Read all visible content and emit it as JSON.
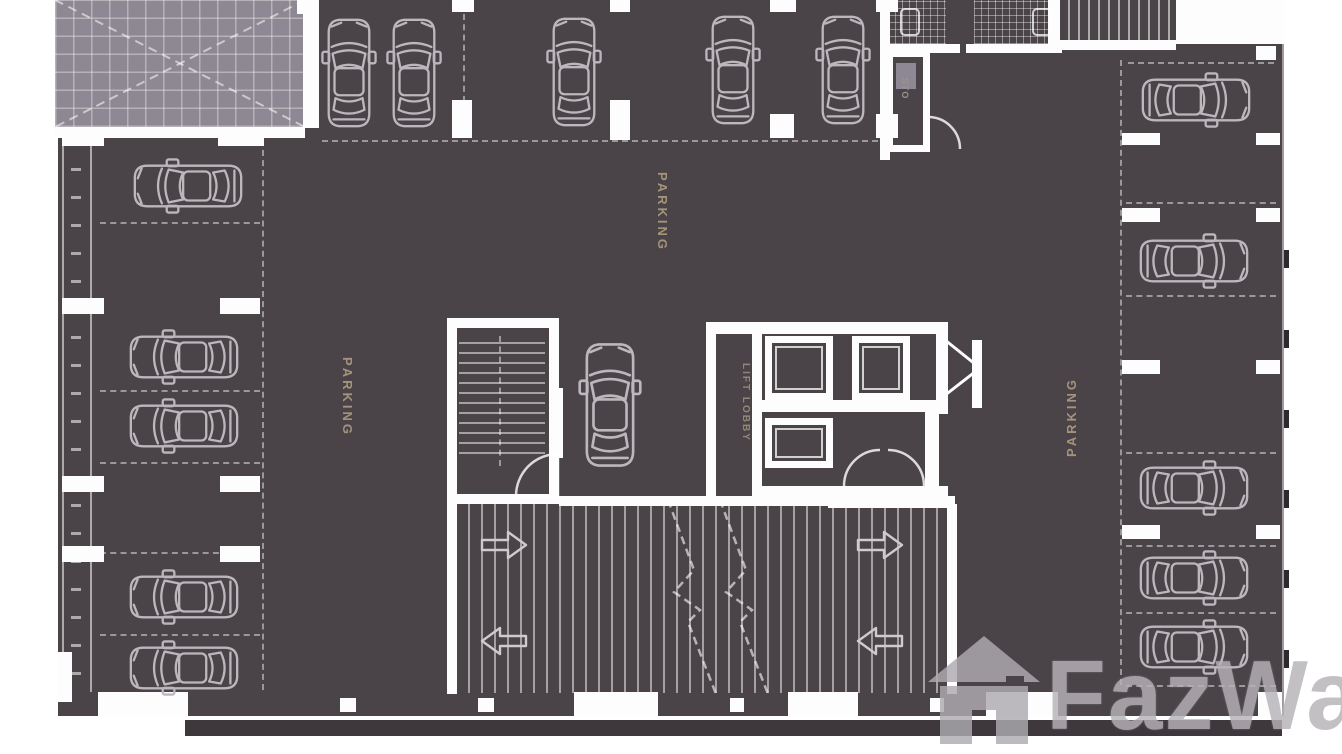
{
  "labels": {
    "parking_center": "PARKING",
    "parking_left": "PARKING",
    "parking_right": "PARKING",
    "lift_lobby": "LIFT LOBBY",
    "storage_room": "STO",
    "watermark": "FazWa"
  },
  "icons": {
    "car": "car-top-view-icon",
    "watermark_house": "house-icon",
    "ramp_arrow": "direction-arrow-icon"
  },
  "colors": {
    "floor": "#4a4347",
    "wall": "#fdfdfd",
    "car_outline": "#bcb6bd",
    "hatch_area": "#8d8893",
    "parking_label": "#a5947c",
    "lift_label": "#938878",
    "watermark_gray": "#b6b3b8"
  },
  "plan": {
    "cars": [
      {
        "cx": 349,
        "cy": 73,
        "rot": 0
      },
      {
        "cx": 414,
        "cy": 73,
        "rot": 0
      },
      {
        "cx": 574,
        "cy": 72,
        "rot": 0
      },
      {
        "cx": 733,
        "cy": 70,
        "rot": 0
      },
      {
        "cx": 843,
        "cy": 70,
        "rot": 0
      },
      {
        "cx": 188,
        "cy": 186,
        "rot": -90
      },
      {
        "cx": 184,
        "cy": 357,
        "rot": -90
      },
      {
        "cx": 184,
        "cy": 426,
        "rot": -90
      },
      {
        "cx": 184,
        "cy": 597,
        "rot": -90
      },
      {
        "cx": 184,
        "cy": 668,
        "rot": -90
      },
      {
        "cx": 610,
        "cy": 405,
        "rot": 0,
        "s": 1.14
      },
      {
        "cx": 1196,
        "cy": 100,
        "rot": 90
      },
      {
        "cx": 1194,
        "cy": 261,
        "rot": 90
      },
      {
        "cx": 1194,
        "cy": 488,
        "rot": 90
      },
      {
        "cx": 1194,
        "cy": 578,
        "rot": 90
      },
      {
        "cx": 1194,
        "cy": 647,
        "rot": 90
      }
    ],
    "columns": [
      {
        "x": 62,
        "y": 128,
        "w": 42,
        "h": 18
      },
      {
        "x": 218,
        "y": 128,
        "w": 46,
        "h": 18
      },
      {
        "x": 62,
        "y": 298,
        "w": 42,
        "h": 16
      },
      {
        "x": 220,
        "y": 298,
        "w": 40,
        "h": 16
      },
      {
        "x": 62,
        "y": 476,
        "w": 42,
        "h": 16
      },
      {
        "x": 220,
        "y": 476,
        "w": 40,
        "h": 16
      },
      {
        "x": 62,
        "y": 546,
        "w": 42,
        "h": 16
      },
      {
        "x": 220,
        "y": 546,
        "w": 40,
        "h": 16
      },
      {
        "x": 297,
        "y": 0,
        "w": 18,
        "h": 14
      },
      {
        "x": 452,
        "y": 0,
        "w": 22,
        "h": 12
      },
      {
        "x": 452,
        "y": 100,
        "w": 20,
        "h": 38
      },
      {
        "x": 610,
        "y": 0,
        "w": 20,
        "h": 12
      },
      {
        "x": 610,
        "y": 100,
        "w": 20,
        "h": 40
      },
      {
        "x": 770,
        "y": 0,
        "w": 26,
        "h": 12
      },
      {
        "x": 770,
        "y": 114,
        "w": 24,
        "h": 24
      },
      {
        "x": 876,
        "y": 0,
        "w": 22,
        "h": 12
      },
      {
        "x": 876,
        "y": 114,
        "w": 22,
        "h": 24
      },
      {
        "x": 1122,
        "y": 133,
        "w": 38,
        "h": 12
      },
      {
        "x": 1256,
        "y": 133,
        "w": 24,
        "h": 12
      },
      {
        "x": 1122,
        "y": 208,
        "w": 38,
        "h": 14
      },
      {
        "x": 1256,
        "y": 208,
        "w": 24,
        "h": 14
      },
      {
        "x": 1122,
        "y": 360,
        "w": 38,
        "h": 14
      },
      {
        "x": 1256,
        "y": 360,
        "w": 24,
        "h": 14
      },
      {
        "x": 1122,
        "y": 525,
        "w": 38,
        "h": 14
      },
      {
        "x": 1256,
        "y": 525,
        "w": 24,
        "h": 14
      },
      {
        "x": 98,
        "y": 692,
        "w": 90,
        "h": 24
      },
      {
        "x": 574,
        "y": 692,
        "w": 84,
        "h": 24
      },
      {
        "x": 788,
        "y": 692,
        "w": 70,
        "h": 24
      },
      {
        "x": 986,
        "y": 692,
        "w": 72,
        "h": 24
      },
      {
        "x": 340,
        "y": 698,
        "w": 16,
        "h": 14
      },
      {
        "x": 478,
        "y": 698,
        "w": 16,
        "h": 14
      },
      {
        "x": 730,
        "y": 698,
        "w": 14,
        "h": 14
      },
      {
        "x": 930,
        "y": 698,
        "w": 14,
        "h": 14
      },
      {
        "x": 1258,
        "y": 692,
        "w": 24,
        "h": 24
      }
    ],
    "dashes": [
      {
        "x": 100,
        "y": 222,
        "len": 160,
        "o": "h"
      },
      {
        "x": 100,
        "y": 390,
        "len": 160,
        "o": "h"
      },
      {
        "x": 100,
        "y": 462,
        "len": 160,
        "o": "h"
      },
      {
        "x": 100,
        "y": 552,
        "len": 160,
        "o": "h"
      },
      {
        "x": 100,
        "y": 634,
        "len": 160,
        "o": "h"
      },
      {
        "x": 322,
        "y": 140,
        "len": 556,
        "o": "h"
      },
      {
        "x": 1128,
        "y": 62,
        "len": 146,
        "o": "h"
      },
      {
        "x": 1126,
        "y": 202,
        "len": 150,
        "o": "h"
      },
      {
        "x": 1126,
        "y": 295,
        "len": 150,
        "o": "h"
      },
      {
        "x": 1126,
        "y": 452,
        "len": 150,
        "o": "h"
      },
      {
        "x": 1126,
        "y": 545,
        "len": 150,
        "o": "h"
      },
      {
        "x": 1126,
        "y": 612,
        "len": 150,
        "o": "h"
      },
      {
        "x": 1126,
        "y": 685,
        "len": 150,
        "o": "h"
      },
      {
        "x": 262,
        "y": 150,
        "len": 540,
        "o": "v"
      },
      {
        "x": 1120,
        "y": 60,
        "len": 625,
        "o": "v"
      },
      {
        "x": 463,
        "y": 14,
        "len": 88,
        "o": "v"
      }
    ],
    "arrows": [
      {
        "x": 480,
        "y": 530,
        "dir": 1
      },
      {
        "x": 480,
        "y": 626,
        "dir": -1
      },
      {
        "x": 856,
        "y": 530,
        "dir": 1
      },
      {
        "x": 856,
        "y": 626,
        "dir": -1
      }
    ],
    "edge_ticks_y": [
      250,
      330,
      410,
      490,
      570,
      650
    ]
  }
}
